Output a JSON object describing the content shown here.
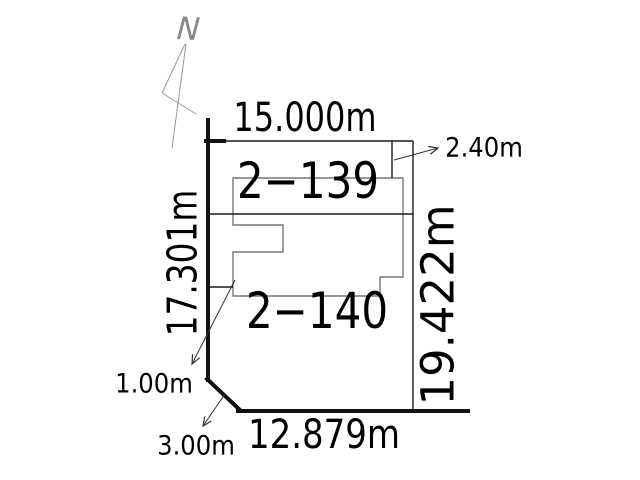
{
  "north": {
    "label": "N"
  },
  "parcels": {
    "upper": {
      "id": "2−139"
    },
    "lower": {
      "id": "2−140"
    }
  },
  "dimensions": {
    "top": "15.000m",
    "left": "17.301m",
    "right": "19.422m",
    "bottom": "12.879m",
    "strip": "2.40m",
    "offset": "1.00m",
    "chamfer": "3.00m"
  },
  "colors": {
    "boundary_thick": "#111111",
    "boundary_thin": "#1c1c1c",
    "building_outline": "#777777",
    "leader_line": "#333333",
    "north_arrow": "#999999",
    "background": "#ffffff"
  }
}
